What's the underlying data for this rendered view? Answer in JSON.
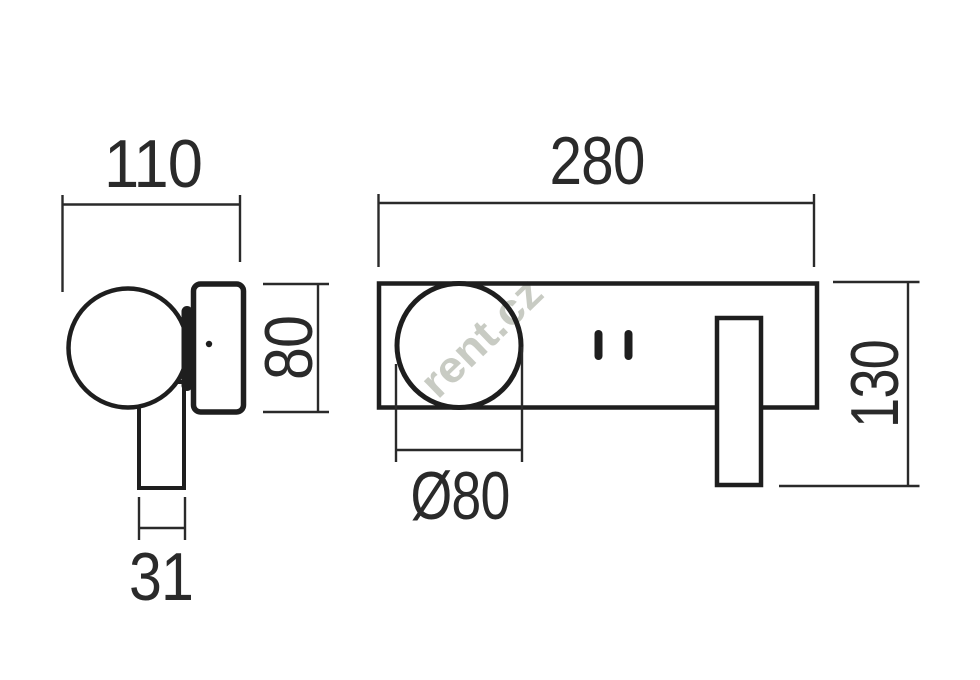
{
  "drawing": {
    "kind": "technical-dimension-drawing",
    "background": "#ffffff",
    "line_color": "#1e1e1e",
    "dimension_color": "#2a2a2a"
  },
  "dimensions": {
    "side_total_depth": "110",
    "front_total_width": "280",
    "body_height": "80",
    "total_height": "130",
    "ball_diameter": "Ø80",
    "stem_width": "31"
  },
  "watermark": {
    "text": "rent.cz",
    "color": "#c8cbc3"
  }
}
